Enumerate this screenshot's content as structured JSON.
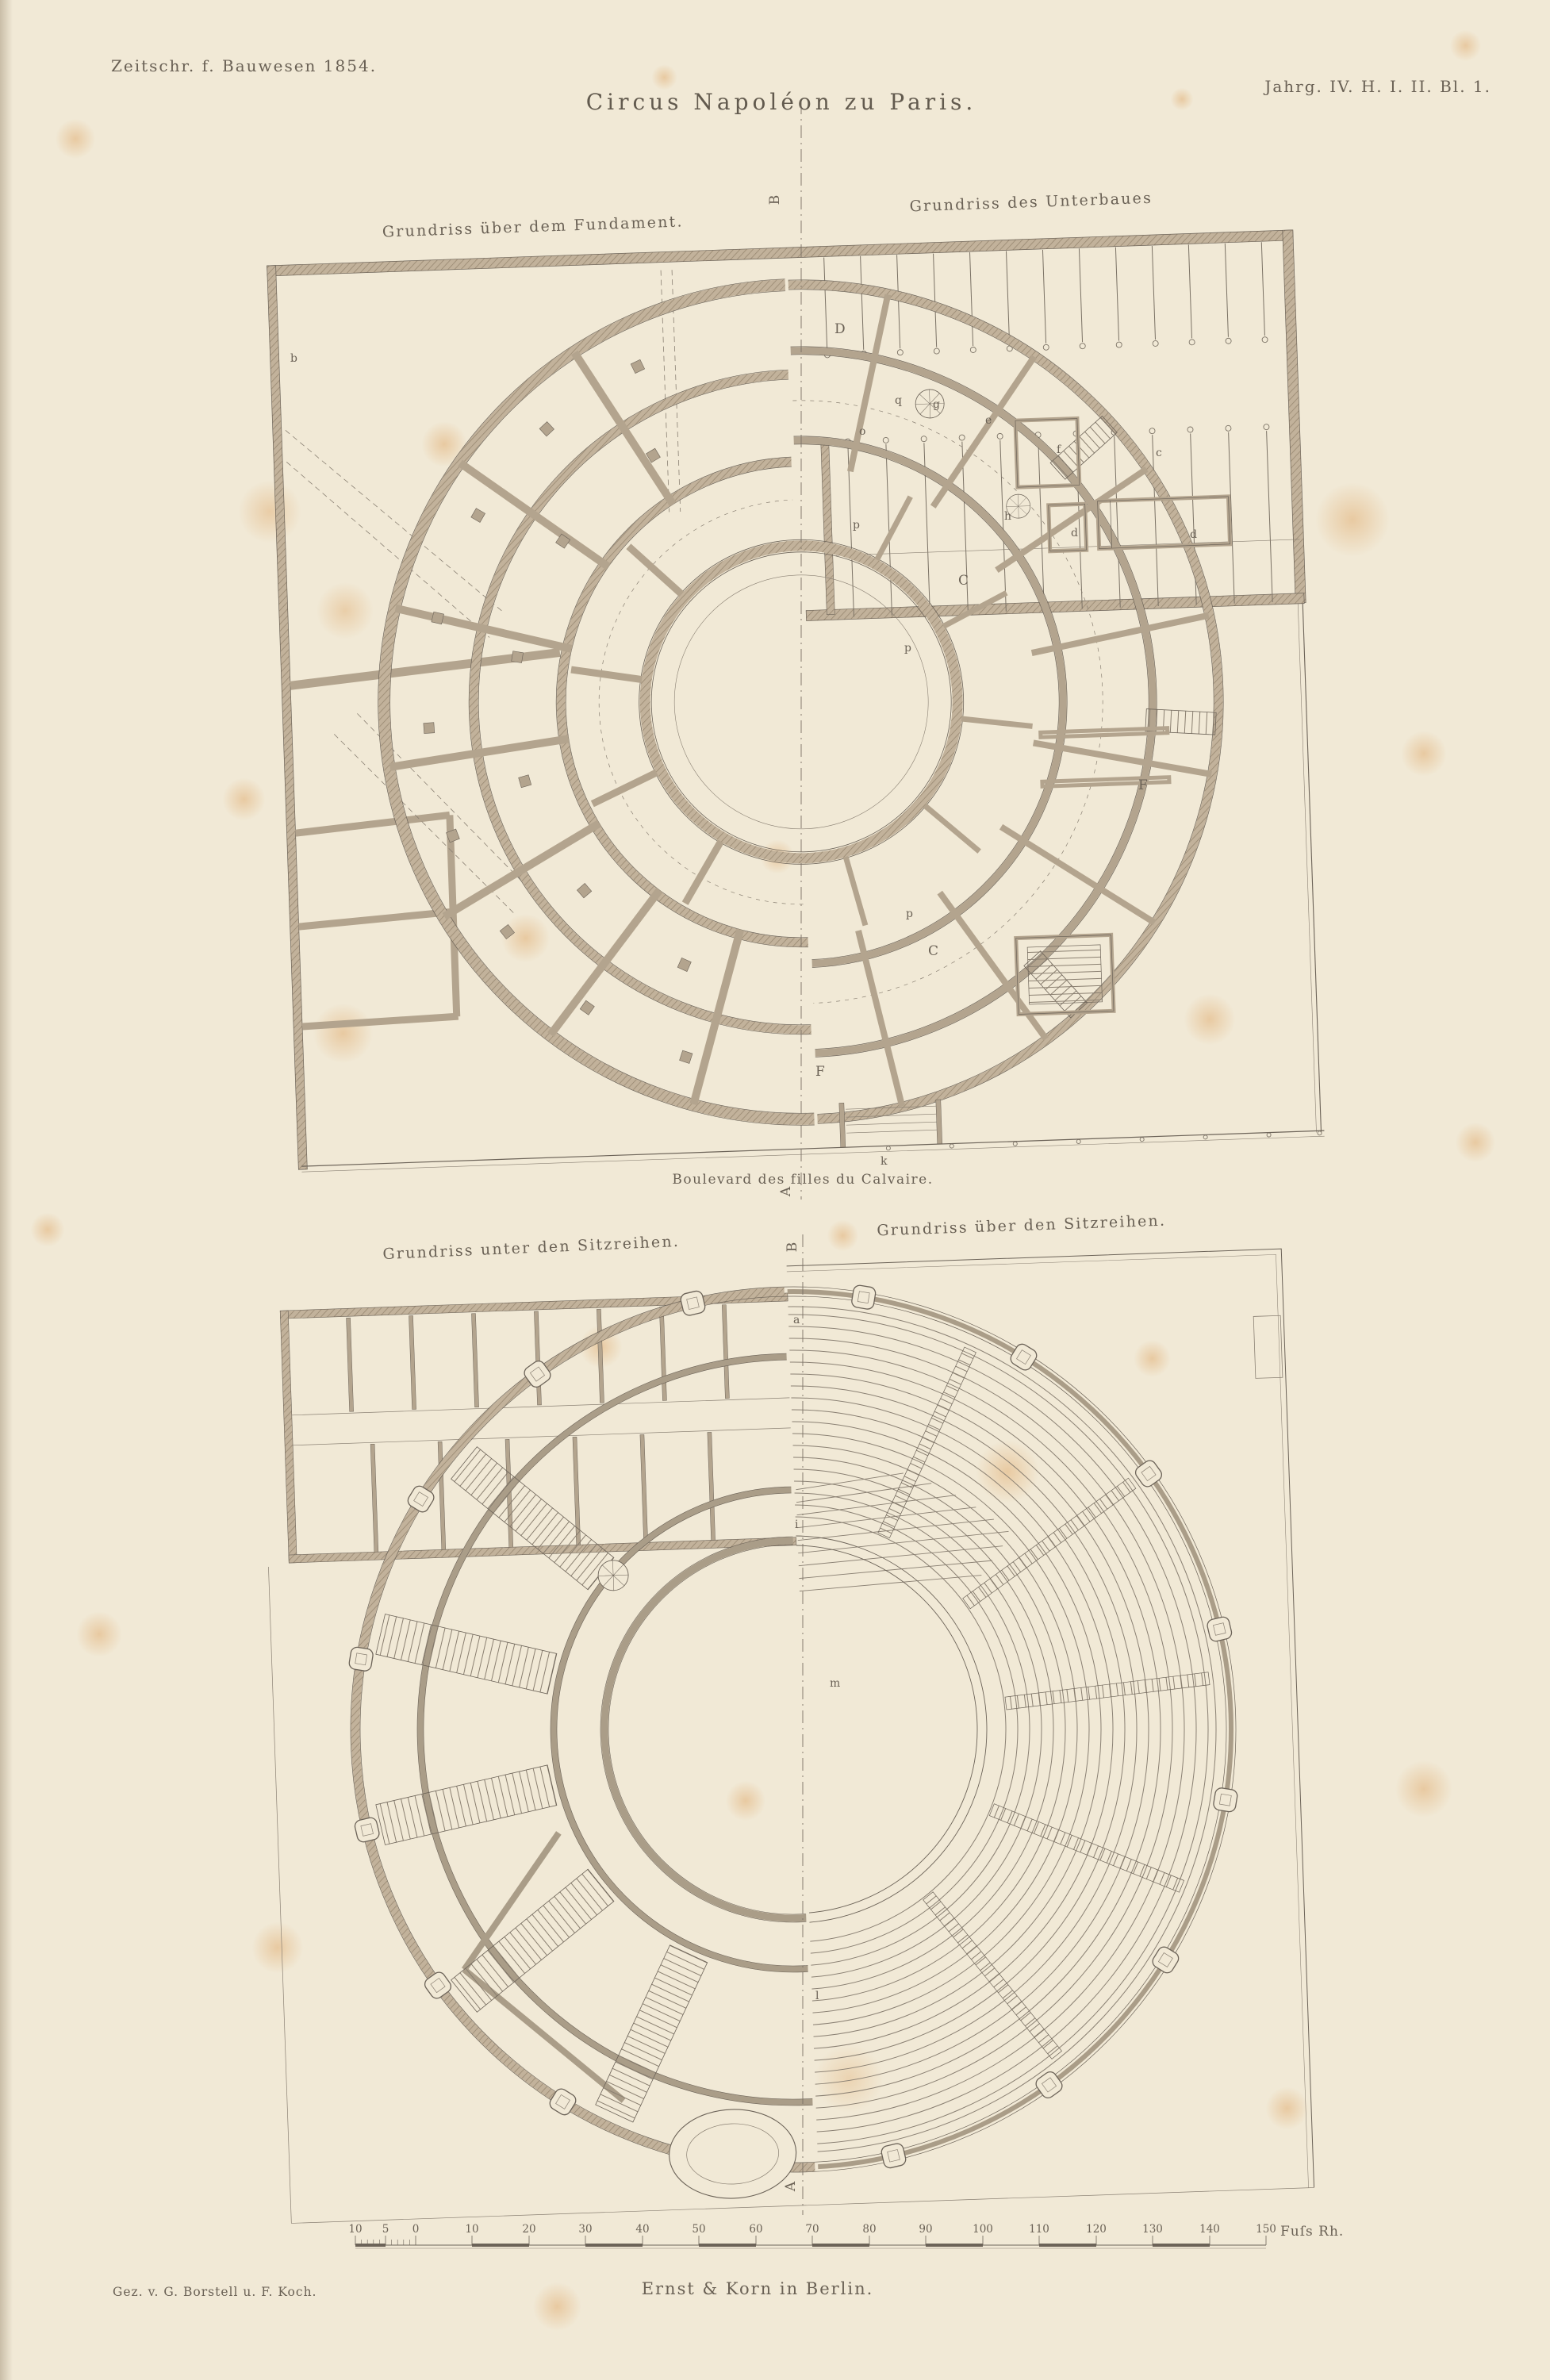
{
  "plate": {
    "journal_header": "Zeitschr. f. Bauwesen 1854.",
    "title": "Circus Napoléon zu Paris.",
    "issue_ref": "Jahrg. IV. H. I. II. Bl. 1.",
    "credit": "Gez. v. G. Borstell u. F. Koch.",
    "publisher": "Ernst & Korn in Berlin."
  },
  "plans": {
    "upper_left": "Grundriss über dem Fundament.",
    "upper_right": "Grundriss des Unterbaues",
    "street": "Boulevard des filles du Calvaire.",
    "lower_left": "Grundriss unter den Sitzreihen.",
    "lower_right": "Grundriss über den Sitzreihen."
  },
  "letters": {
    "upper": [
      {
        "t": "B"
      },
      {
        "t": "D"
      },
      {
        "t": "b"
      },
      {
        "t": "q"
      },
      {
        "t": "o"
      },
      {
        "t": "g"
      },
      {
        "t": "e"
      },
      {
        "t": "f"
      },
      {
        "t": "c"
      },
      {
        "t": "h"
      },
      {
        "t": "d"
      },
      {
        "t": "d"
      },
      {
        "t": "p"
      },
      {
        "t": "C"
      },
      {
        "t": "p"
      },
      {
        "t": "F"
      },
      {
        "t": "p"
      },
      {
        "t": "C"
      },
      {
        "t": "F"
      },
      {
        "t": "k"
      },
      {
        "t": "A"
      }
    ],
    "lower": [
      {
        "t": "B"
      },
      {
        "t": "a"
      },
      {
        "t": "i"
      },
      {
        "t": "m"
      },
      {
        "t": "l"
      },
      {
        "t": "A"
      }
    ]
  },
  "scalebar": {
    "labels": [
      "10",
      "5",
      "0",
      "10",
      "20",
      "30",
      "40",
      "50",
      "60",
      "70",
      "80",
      "90",
      "100",
      "110",
      "120",
      "130",
      "140",
      "150"
    ],
    "unit": "Fuſs Rh."
  },
  "colors": {
    "paper": "#f1e9d6",
    "ink": "#6c6358",
    "wall": "#b3a48e",
    "stain": "#dc9e58"
  }
}
